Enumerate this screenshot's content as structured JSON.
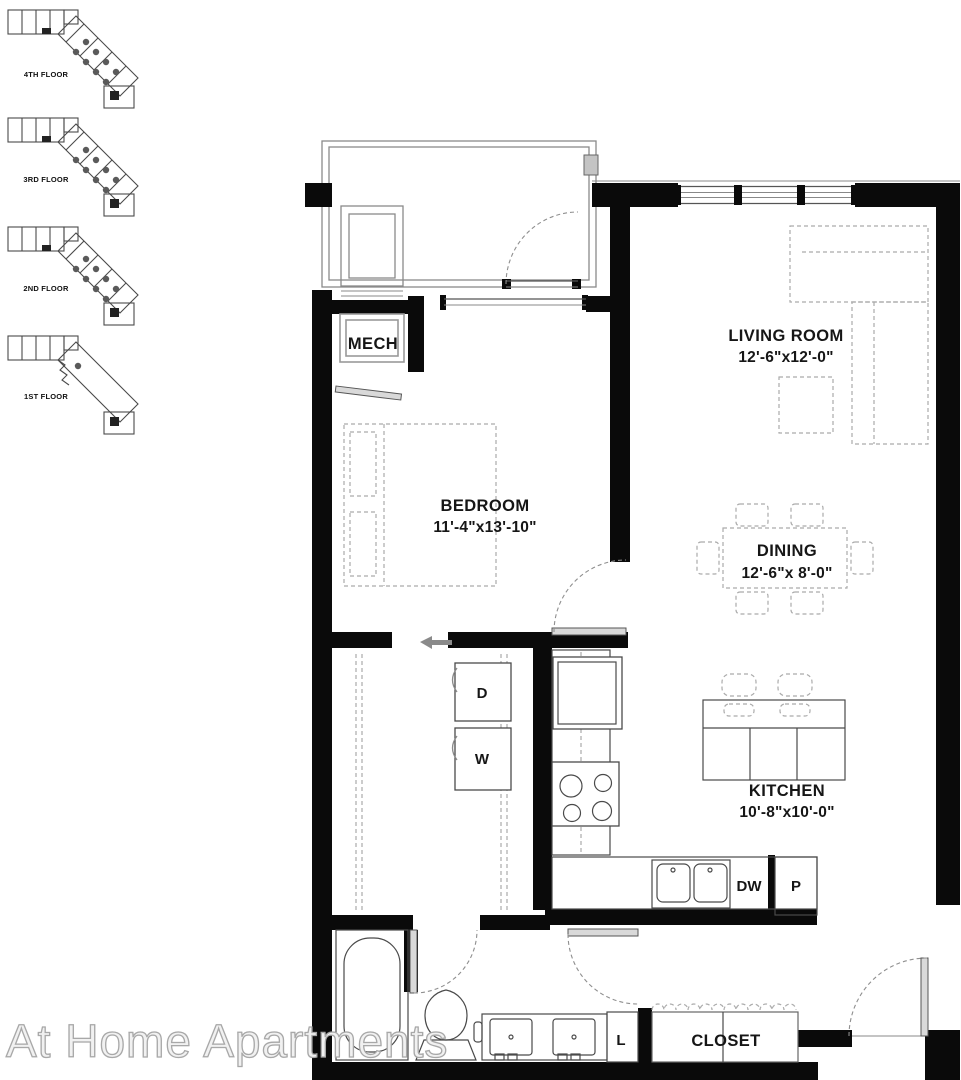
{
  "watermark": {
    "text": "At Home Apartments"
  },
  "floor_keys": [
    {
      "label": "4TH FLOOR"
    },
    {
      "label": "3RD FLOOR"
    },
    {
      "label": "2ND FLOOR"
    },
    {
      "label": "1ST FLOOR"
    }
  ],
  "rooms": {
    "living": {
      "name": "LIVING ROOM",
      "dims": "12'-6\"x12'-0\""
    },
    "bedroom": {
      "name": "BEDROOM",
      "dims": "11'-4\"x13'-10\""
    },
    "dining": {
      "name": "DINING",
      "dims": "12'-6\"x 8'-0\""
    },
    "kitchen": {
      "name": "KITCHEN",
      "dims": "10'-8\"x10'-0\""
    },
    "mech": {
      "name": "MECH"
    },
    "closet": {
      "name": "CLOSET"
    }
  },
  "fixtures": {
    "dryer": "D",
    "washer": "W",
    "dishwasher": "DW",
    "pantry": "P",
    "linen": "L"
  },
  "colors": {
    "walls": "#0a0a0a",
    "linework": "#555555",
    "furniture_dash": "#ababab",
    "watermark_text": "#f1f1f1",
    "floor_key_dot": "#5a5a5a"
  }
}
